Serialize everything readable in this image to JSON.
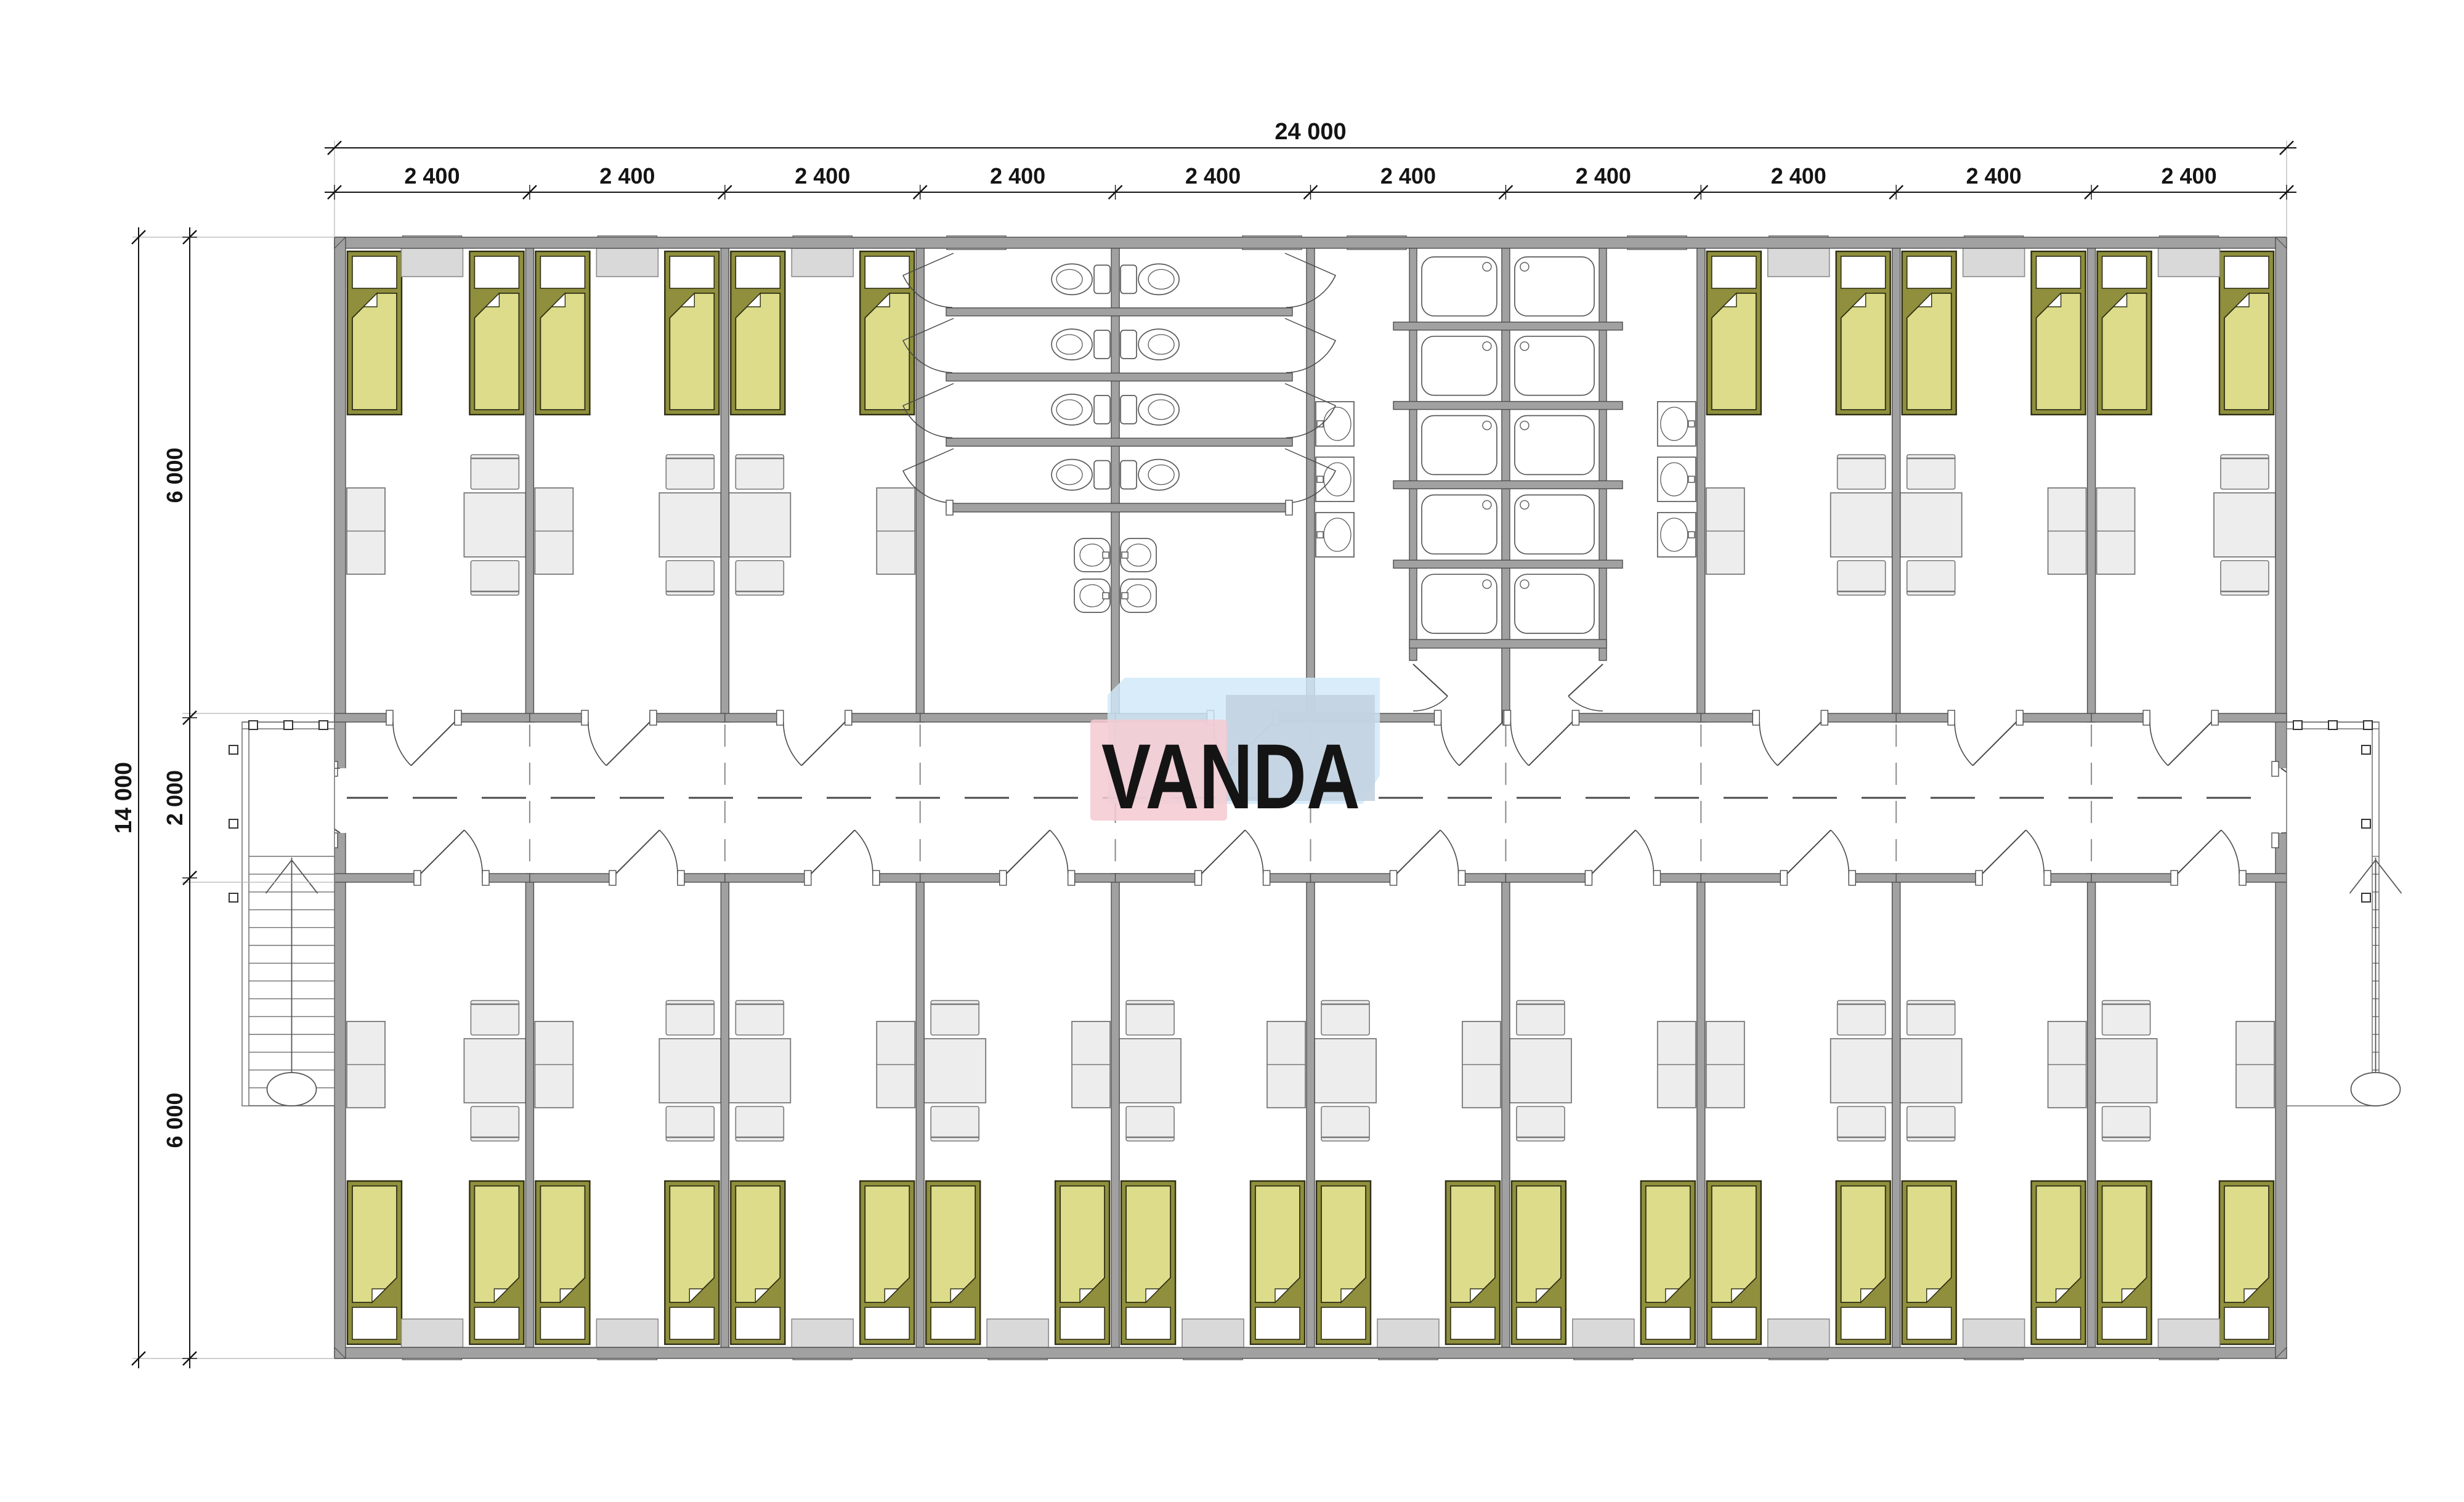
{
  "watermark": {
    "text": "VANDA",
    "pink": "#f5c9d2",
    "blue": "#cfe9f8",
    "steel": "#c3d2e0",
    "letter_color": "#ffffff"
  },
  "dimensions": {
    "top_total_label": "24 000",
    "top_segment_labels": [
      "2 400",
      "2 400",
      "2 400",
      "2 400",
      "2 400",
      "2 400",
      "2 400",
      "2 400",
      "2 400",
      "2 400"
    ],
    "left_total_label": "14 000",
    "left_segment_labels": [
      "6 000",
      "2 000",
      "6 000"
    ],
    "units_mm": {
      "total_width": 24000,
      "bay": 2400,
      "total_height": 14000,
      "band": 6000,
      "corridor": 2000
    }
  },
  "plan": {
    "bays": 10,
    "colors": {
      "wall_fill": "#a1a1a1",
      "wall_stroke": "#4f4f4f",
      "bed_frame": "#8f8f3d",
      "bed_blanket": "#dcdc8a",
      "bed_outline": "#2e2e14",
      "furniture_fill": "#ededed",
      "furniture_stroke": "#787878",
      "cabinet_fill": "#d9d9d9",
      "fixture_stroke": "#5a5a5a",
      "dim_color": "#141414",
      "line_color": "#4a4a4a"
    },
    "top_rooms": [
      {
        "type": "bedroom",
        "table": "R",
        "wardrobe": "L"
      },
      {
        "type": "bedroom",
        "table": "R",
        "wardrobe": "L"
      },
      {
        "type": "bedroom",
        "table": "L",
        "wardrobe": "R"
      },
      {
        "type": "wc",
        "stall_rows": 4,
        "stall_cols": 2,
        "toilets": 8,
        "sinks": 4
      },
      {
        "type": "wc-cont"
      },
      {
        "type": "shower",
        "stall_rows": 5,
        "stall_cols": 2,
        "trays": 10,
        "wall_basins": 6
      },
      {
        "type": "shower-cont"
      },
      {
        "type": "bedroom",
        "table": "R",
        "wardrobe": "L"
      },
      {
        "type": "bedroom",
        "table": "L",
        "wardrobe": "R"
      },
      {
        "type": "bedroom",
        "table": "R",
        "wardrobe": "L"
      }
    ],
    "bottom_rooms": [
      {
        "type": "bedroom",
        "table": "R",
        "wardrobe": "L"
      },
      {
        "type": "bedroom",
        "table": "R",
        "wardrobe": "L"
      },
      {
        "type": "bedroom",
        "table": "L",
        "wardrobe": "R"
      },
      {
        "type": "bedroom",
        "table": "L",
        "wardrobe": "R"
      },
      {
        "type": "bedroom",
        "table": "L",
        "wardrobe": "R"
      },
      {
        "type": "bedroom",
        "table": "L",
        "wardrobe": "R"
      },
      {
        "type": "bedroom",
        "table": "L",
        "wardrobe": "R"
      },
      {
        "type": "bedroom",
        "table": "R",
        "wardrobe": "L"
      },
      {
        "type": "bedroom",
        "table": "L",
        "wardrobe": "R"
      },
      {
        "type": "bedroom",
        "table": "L",
        "wardrobe": "R"
      }
    ],
    "beds_per_bedroom": 2,
    "stairs": {
      "left": true,
      "right": true,
      "treads": 14
    }
  }
}
